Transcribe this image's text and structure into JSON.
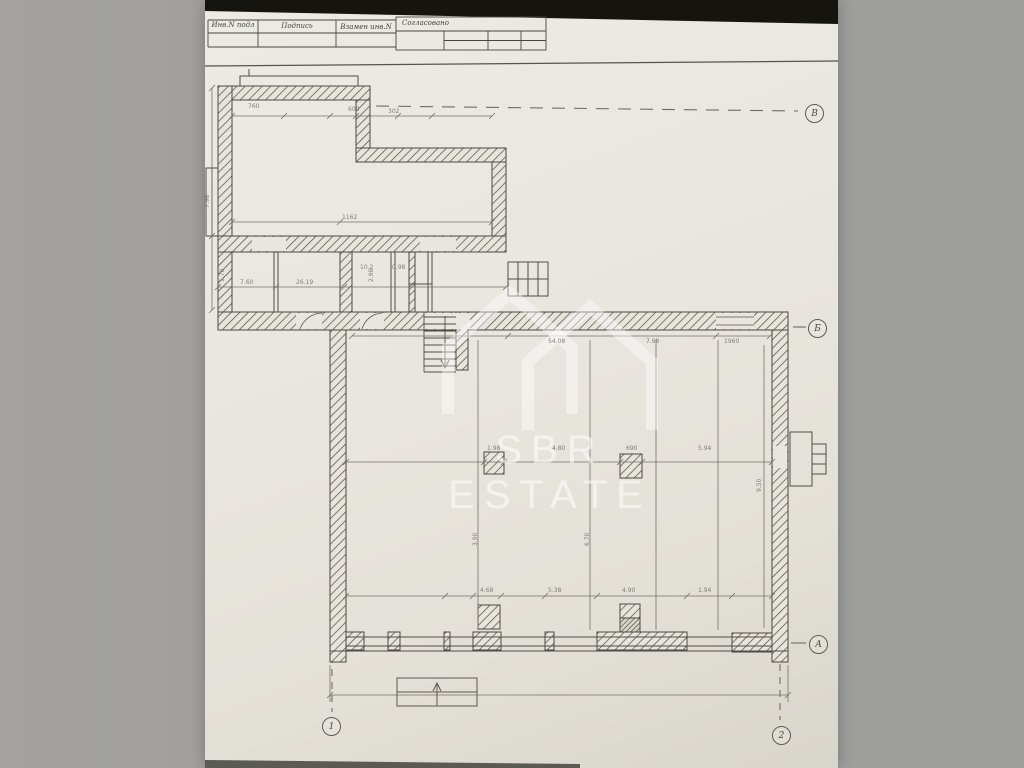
{
  "title_block": {
    "cells": [
      {
        "label": "Инв.N подл"
      },
      {
        "label": "Подпись"
      },
      {
        "label": "Взамен инв.N"
      }
    ],
    "approved_label": "Согласовано"
  },
  "watermark": {
    "brand": "SBR ESTATE",
    "logo_icon": "sbr-double-house-roof",
    "color": "#ffffff"
  },
  "axes": {
    "right": [
      {
        "label": "В"
      },
      {
        "label": "Б"
      },
      {
        "label": "А"
      }
    ],
    "bottom": [
      {
        "label": "1"
      },
      {
        "label": "2"
      }
    ]
  },
  "dims": [
    {
      "t": "760"
    },
    {
      "t": "600"
    },
    {
      "t": "302"
    },
    {
      "t": "1162"
    },
    {
      "t": "7.60"
    },
    {
      "t": "26.19"
    },
    {
      "t": "0.98"
    },
    {
      "t": "10.2"
    },
    {
      "t": "54.08"
    },
    {
      "t": "7.98"
    },
    {
      "t": "1960"
    },
    {
      "t": "1.98"
    },
    {
      "t": "4.80"
    },
    {
      "t": "690"
    },
    {
      "t": "5.94"
    },
    {
      "t": "9.50"
    },
    {
      "t": "3.90"
    },
    {
      "t": "6.70"
    },
    {
      "t": "4.68"
    },
    {
      "t": "5.38"
    },
    {
      "t": "4.90"
    },
    {
      "t": "1.94"
    },
    {
      "t": "7.98"
    },
    {
      "t": "1.70"
    },
    {
      "t": "2.98"
    }
  ]
}
